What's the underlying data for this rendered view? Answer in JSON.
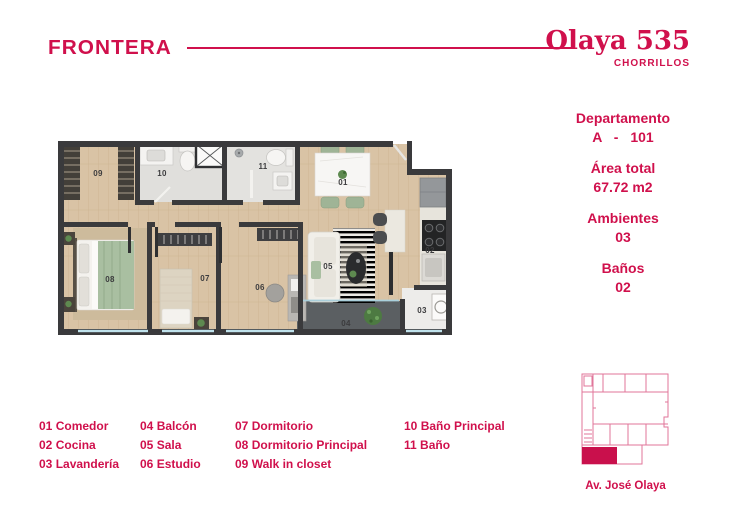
{
  "brand": {
    "name": "FRONTERA",
    "accent_color": "#d0104c"
  },
  "project": {
    "name": "Olaya 535",
    "location": "CHORRILLOS"
  },
  "info": {
    "groups": [
      {
        "label": "Departamento",
        "value": "A - 101"
      },
      {
        "label": "Área total",
        "value": "67.72 m2"
      },
      {
        "label": "Ambientes",
        "value": "03"
      },
      {
        "label": "Baños",
        "value": "02"
      }
    ]
  },
  "floorplan": {
    "room_numbers": [
      "01",
      "02",
      "03",
      "04",
      "05",
      "06",
      "07",
      "08",
      "09",
      "10",
      "11"
    ]
  },
  "legend": {
    "columns": [
      {
        "items": [
          {
            "num": "01",
            "label": "Comedor"
          },
          {
            "num": "02",
            "label": "Cocina"
          },
          {
            "num": "03",
            "label": "Lavandería"
          }
        ]
      },
      {
        "items": [
          {
            "num": "04",
            "label": "Balcón"
          },
          {
            "num": "05",
            "label": "Sala"
          },
          {
            "num": "06",
            "label": "Estudio"
          }
        ]
      },
      {
        "items": [
          {
            "num": "07",
            "label": "Dormitorio"
          },
          {
            "num": "08",
            "label": "Dormitorio Principal"
          },
          {
            "num": "09",
            "label": "Walk in closet"
          }
        ]
      },
      {
        "items": [
          {
            "num": "10",
            "label": "Baño Principal"
          },
          {
            "num": "11",
            "label": "Baño"
          }
        ]
      }
    ]
  },
  "map": {
    "street": "Av. José Olaya"
  }
}
